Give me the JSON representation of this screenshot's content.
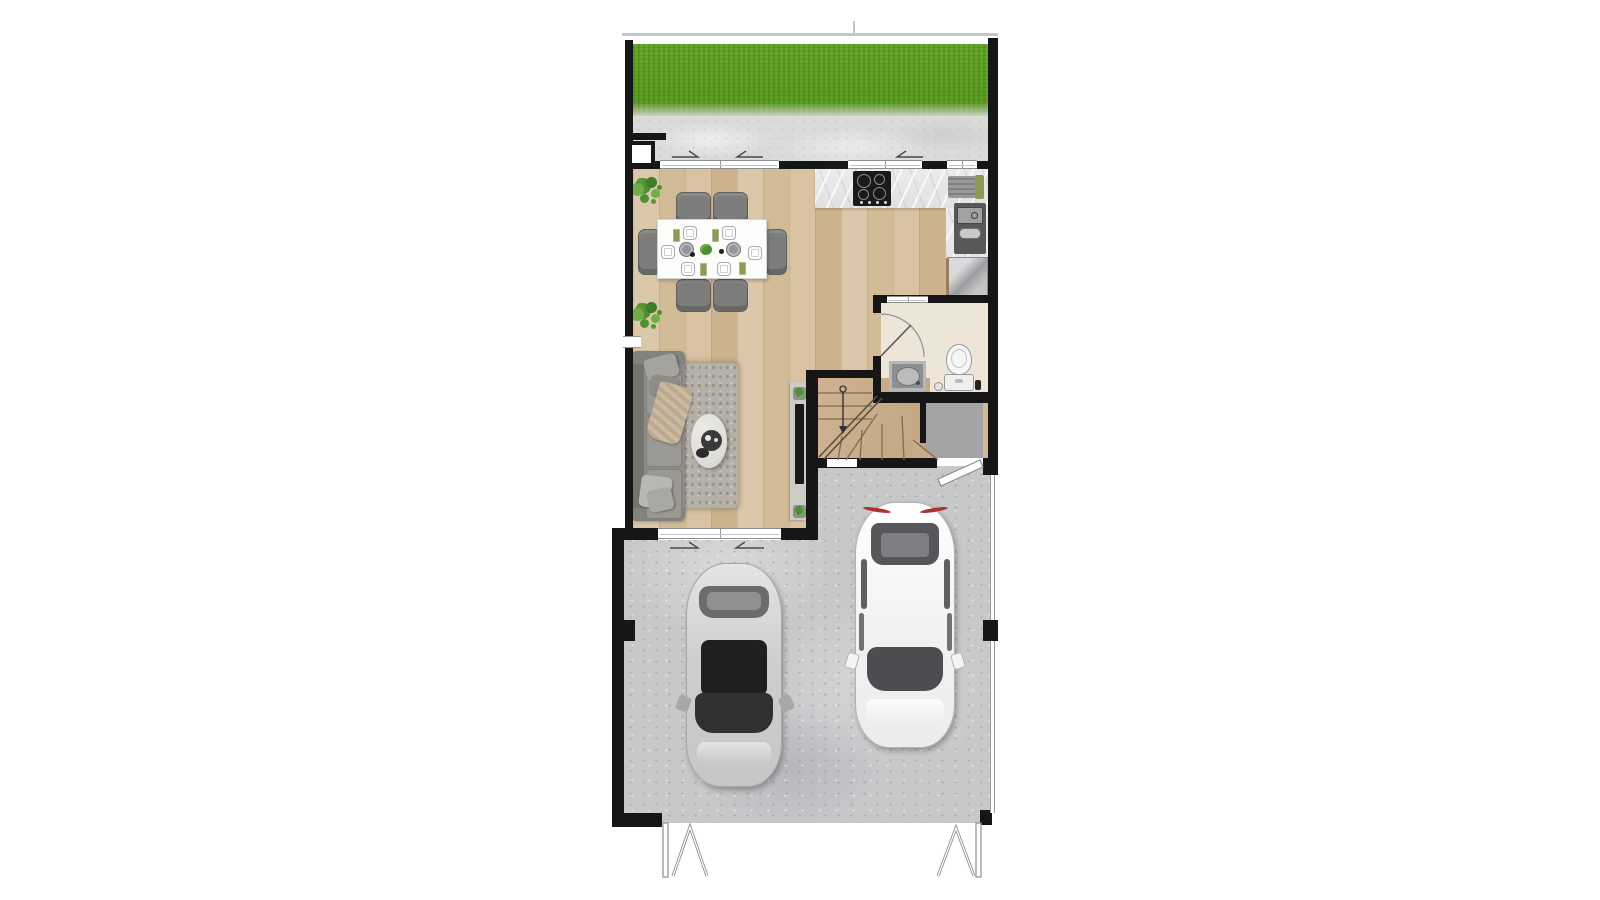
{
  "meta": {
    "kind": "architectural-floor-plan",
    "view": "top-down",
    "visible_text": ""
  },
  "colors": {
    "wall": "#161616",
    "line": "#c6c6c6",
    "grass": "#5f9e24",
    "terrace": "#dadad9",
    "wood": "#d6c1a1",
    "stairs-wood": "#c9ad8b",
    "marble": "#e9e9e8",
    "concrete": "#c7c8ca",
    "hall": "#a4a4a6",
    "bath-floor": "#eee5d9",
    "sofa": "#8d8b85",
    "rug": "#b5b0a8",
    "chair": "#7d7d7b",
    "table": "#fcfcfb",
    "steel": "#a7a9ab",
    "appliance-dark": "#56585a",
    "olive": "#8b9a55",
    "plant": "#4f9032",
    "plant-light": "#6fae46",
    "car-silver": "#d6d6d6",
    "car-white": "#f9f9f9",
    "glass": "#434547",
    "roof-black": "#1f1f1f",
    "tail-red": "#ac3331",
    "tv": "#181818",
    "console": "#cdcbc6"
  },
  "rooms": [
    {
      "name": "garden"
    },
    {
      "name": "terrace"
    },
    {
      "name": "dining-area"
    },
    {
      "name": "kitchen"
    },
    {
      "name": "bathroom"
    },
    {
      "name": "hallway"
    },
    {
      "name": "stairs"
    },
    {
      "name": "living-area"
    },
    {
      "name": "garage-driveway"
    }
  ],
  "furniture": [
    "dining-table",
    "dining-chairs-x6",
    "decor-plants",
    "kitchen-counter",
    "cooktop",
    "kitchen-appliance",
    "sink-unit",
    "refrigerator",
    "washbasin",
    "toilet",
    "floor-drain",
    "sofa",
    "throw-pillows",
    "area-rug",
    "coffee-table",
    "tv-console",
    "television",
    "staircase-with-down-arrow",
    "bathroom-door-swing",
    "garage-side-door-swing",
    "sliding-window-arrows",
    "gate-posts",
    "car-silver",
    "car-white"
  ]
}
